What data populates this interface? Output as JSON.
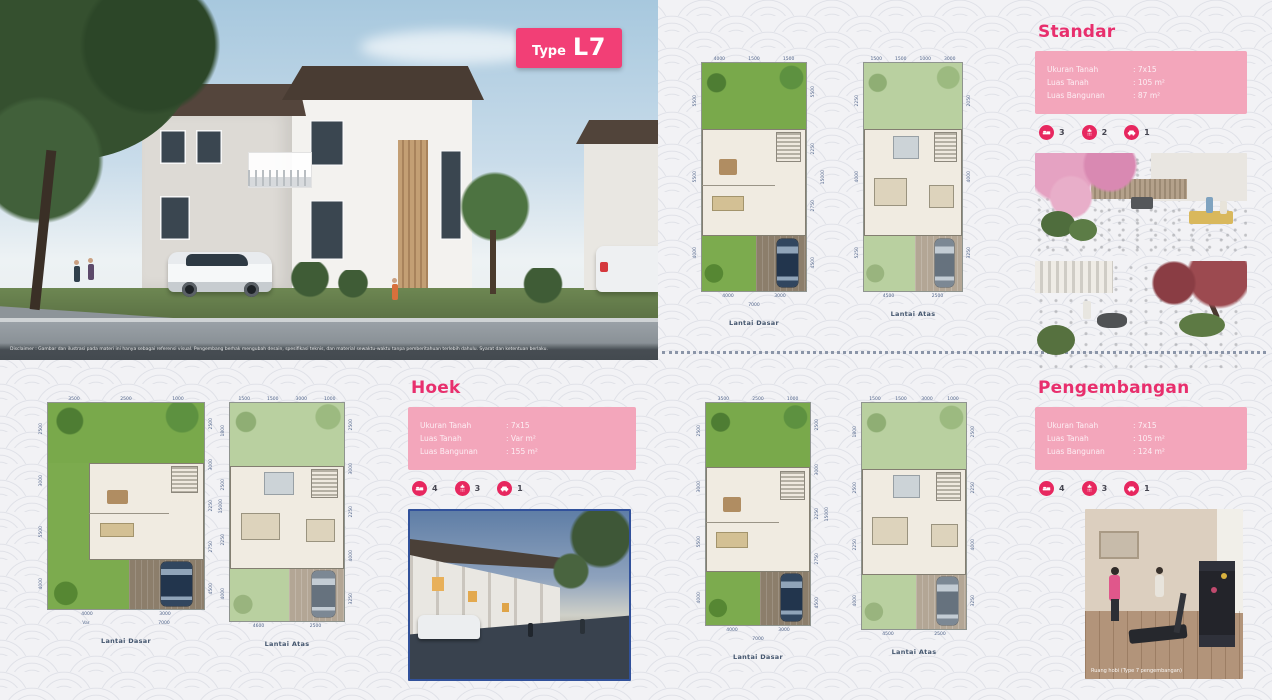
{
  "badge": {
    "prefix": "Type",
    "code": "L7"
  },
  "hero": {
    "disclaimer": "Disclaimer : Gambar dan ilustrasi pada materi ini hanya sebagai referensi visual. Pengembang berhak mengubah desain, spesifikasi teknis, dan material sewaktu-waktu tanpa pemberitahuan terlebih dahulu. Syarat dan ketentuan berlaku."
  },
  "sections": {
    "standar": {
      "title": "Standar",
      "specs": [
        {
          "label": "Ukuran Tanah",
          "value": ": 7x15"
        },
        {
          "label": "Luas Tanah",
          "value": ": 105 m²"
        },
        {
          "label": "Luas Bangunan",
          "value": ": 87 m²"
        }
      ],
      "amenities": [
        {
          "count": "3"
        },
        {
          "count": "2"
        },
        {
          "count": "1"
        }
      ]
    },
    "hoek": {
      "title": "Hoek",
      "specs": [
        {
          "label": "Ukuran Tanah",
          "value": ": 7x15"
        },
        {
          "label": "Luas Tanah",
          "value": ": Var m²"
        },
        {
          "label": "Luas Bangunan",
          "value": ": 155 m²"
        }
      ],
      "amenities": [
        {
          "count": "4"
        },
        {
          "count": "3"
        },
        {
          "count": "1"
        }
      ]
    },
    "pengembangan": {
      "title": "Pengembangan",
      "specs": [
        {
          "label": "Ukuran Tanah",
          "value": ": 7x15"
        },
        {
          "label": "Luas Tanah",
          "value": ": 105 m²"
        },
        {
          "label": "Luas Bangunan",
          "value": ": 124 m²"
        }
      ],
      "amenities": [
        {
          "count": "4"
        },
        {
          "count": "3"
        },
        {
          "count": "1"
        }
      ],
      "photo_caption": "Ruang hobi (Type 7 pengembangan)"
    }
  },
  "plans": {
    "standar_dasar": {
      "label": "Lantai Dasar",
      "top": [
        "4000",
        "1500",
        "1500"
      ],
      "left": [
        "5500",
        "5500",
        "4000"
      ],
      "right": [
        "5500",
        "2250",
        "2750",
        "4500"
      ],
      "right_total": "15000",
      "bottom": [
        "4000",
        "3000"
      ],
      "bottom_total": "7000"
    },
    "standar_atas": {
      "label": "Lantai Atas",
      "top": [
        "1500",
        "1500",
        "1000",
        "3000"
      ],
      "left": [
        "2250",
        "4000",
        "5250"
      ],
      "right": [
        "2050",
        "4000",
        "3250"
      ],
      "bottom": [
        "4500",
        "2500"
      ]
    },
    "hoek_dasar": {
      "label": "Lantai Dasar",
      "top": [
        "3500",
        "2500",
        "1000"
      ],
      "left": [
        "2500",
        "3000",
        "5500",
        "4000"
      ],
      "right": [
        "2500",
        "3000",
        "2250",
        "2750",
        "4500"
      ],
      "right_total": "15000",
      "bottom": [
        "4000",
        "3000"
      ],
      "bottom2": [
        "Var",
        "7000"
      ]
    },
    "hoek_atas": {
      "label": "Lantai Atas",
      "top": [
        "1500",
        "1500",
        "3000",
        "1000"
      ],
      "left": [
        "1800",
        "2500",
        "2250",
        "4000"
      ],
      "right": [
        "2500",
        "3000",
        "2250",
        "4000",
        "3250"
      ],
      "bottom": [
        "4600",
        "2500"
      ]
    },
    "peng_dasar": {
      "label": "Lantai Dasar",
      "top": [
        "3500",
        "2500",
        "1000"
      ],
      "left": [
        "2500",
        "3000",
        "5500",
        "4000"
      ],
      "right": [
        "2500",
        "3000",
        "2250",
        "2750",
        "4500"
      ],
      "right_total": "15000",
      "bottom": [
        "4000",
        "3000"
      ],
      "bottom_total": "7000"
    },
    "peng_atas": {
      "label": "Lantai Atas",
      "top": [
        "1500",
        "1500",
        "3000",
        "1000"
      ],
      "left": [
        "1800",
        "2500",
        "2250",
        "4000"
      ],
      "right": [
        "2500",
        "2250",
        "4000",
        "3250"
      ],
      "bottom": [
        "4500",
        "2500"
      ]
    }
  }
}
